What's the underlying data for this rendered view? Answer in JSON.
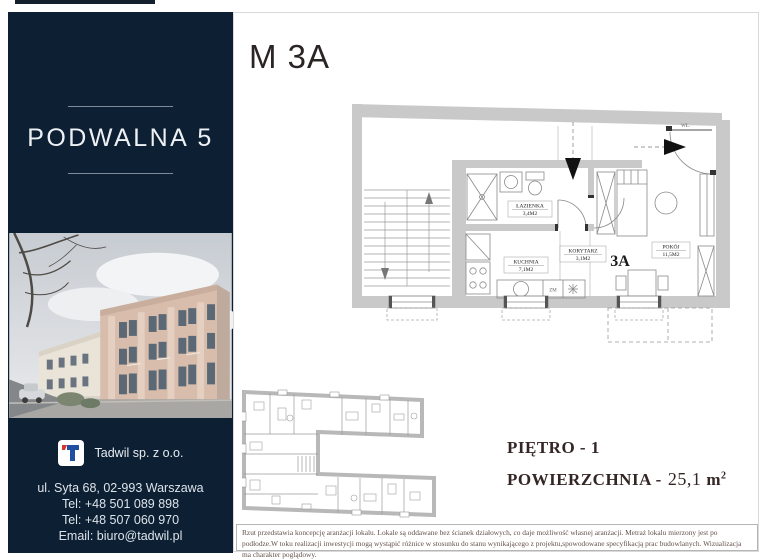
{
  "colors": {
    "sidebar_navy": "#0d1f33",
    "wall_gray": "#c9c9c9",
    "logo_blue": "#1f4fa0",
    "logo_red": "#d8382c"
  },
  "sidebar": {
    "title": "PODWALNA 5",
    "company": {
      "name": "Tadwil sp. z o.o."
    },
    "contact": [
      "ul. Syta 68, 02-993 Warszawa",
      "Tel: +48 501 089 898",
      "Tel: +48 507 060 970",
      "Email: biuro@tadwil.pl"
    ]
  },
  "main": {
    "unit_title": "M 3A",
    "floor_label": "PIĘTRO - 1",
    "area_label": "POWIERZCHNIA -",
    "area_value": "25,1",
    "area_unit": "m",
    "area_sup": "2",
    "plan": {
      "unit_badge": "3A",
      "entrance_label": "WŁ.",
      "kitchen_mark": "ZM",
      "rooms": [
        {
          "name": "ŁAZIENKA",
          "area": "3,4M2"
        },
        {
          "name": "KUCHNIA",
          "area": "7,1M2"
        },
        {
          "name": "KORYTARZ",
          "area": "3,1M2"
        },
        {
          "name": "POKÓJ",
          "area": "11,5M2"
        }
      ]
    },
    "disclaimer": "Rzut przedstawia koncepcję aranżacji lokalu. Lokale są oddawane bez ścianek działowych, co daje możliwość własnej aranżacji. Metraż lokalu mierzony jest po podłodze.W toku realizacji inwestycji mogą wystąpić różnice w stosunku do stanu wynikającego z projektu,spowodowane specyfikacją prac budowlanych. Wizualizacja ma charakter poglądowy."
  }
}
